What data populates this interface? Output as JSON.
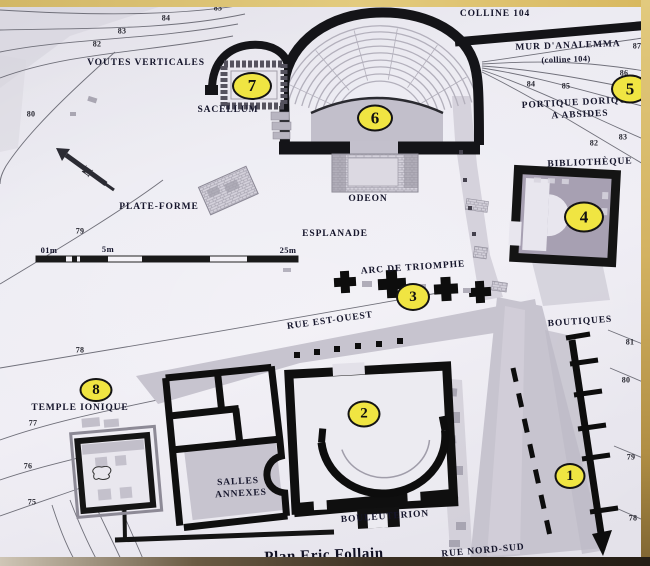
{
  "labels": {
    "colline_104": "COLLINE 104",
    "mur_analemma": "MUR D'ANALEMMA",
    "mur_analemma_sub": "(colline 104)",
    "voutes_verticales": "VOUTES VERTICALES",
    "sacellum": "SACELLUM",
    "portique_line1": "PORTIQUE DORIQUE",
    "portique_line2": "A ABSIDES",
    "bibliotheque": "BIBLIOTHÈQUE",
    "plate_forme": "PLATE-FORME",
    "odeon": "ODEON",
    "esplanade": "ESPLANADE",
    "arc_de_triomphe": "ARC DE TRIOMPHE",
    "rue_est_ouest": "RUE EST-OUEST",
    "boutiques": "BOUTIQUES",
    "temple_ionique": "TEMPLE IONIQUE",
    "salles_line1": "SALLES",
    "salles_line2": "ANNEXES",
    "bouleuterion": "BOULEUTERION",
    "rue_nord_sud": "RUE NORD-SUD",
    "credit": "Plan Eric Follain",
    "north": "N"
  },
  "markers": {
    "m1": "1",
    "m2": "2",
    "m3": "3",
    "m4": "4",
    "m5": "5",
    "m6": "6",
    "m7": "7",
    "m8": "8"
  },
  "scale": {
    "tick_0_1": "01m",
    "tick_5": "5m",
    "tick_25": "25m"
  },
  "contours": {
    "tl_85": "85",
    "tl_84": "84",
    "tl_83": "83",
    "tl_82": "82",
    "l_80": "80",
    "l_79": "79",
    "l_78": "78",
    "l_77": "77",
    "l_76": "76",
    "l_75": "75",
    "tr_87": "87",
    "tr_86": "86",
    "tr_85": "85",
    "tr_84": "84",
    "tr_83": "83",
    "tr_82": "82",
    "r_81": "81",
    "r_80": "80",
    "r_79": "79",
    "r_78": "78"
  },
  "colors": {
    "marker_yellow": "#f0e542",
    "wall_black": "#141414",
    "road_gray": "#c7c4cf",
    "paper": "#ecebf2",
    "frame_tan": "#d5b968"
  }
}
